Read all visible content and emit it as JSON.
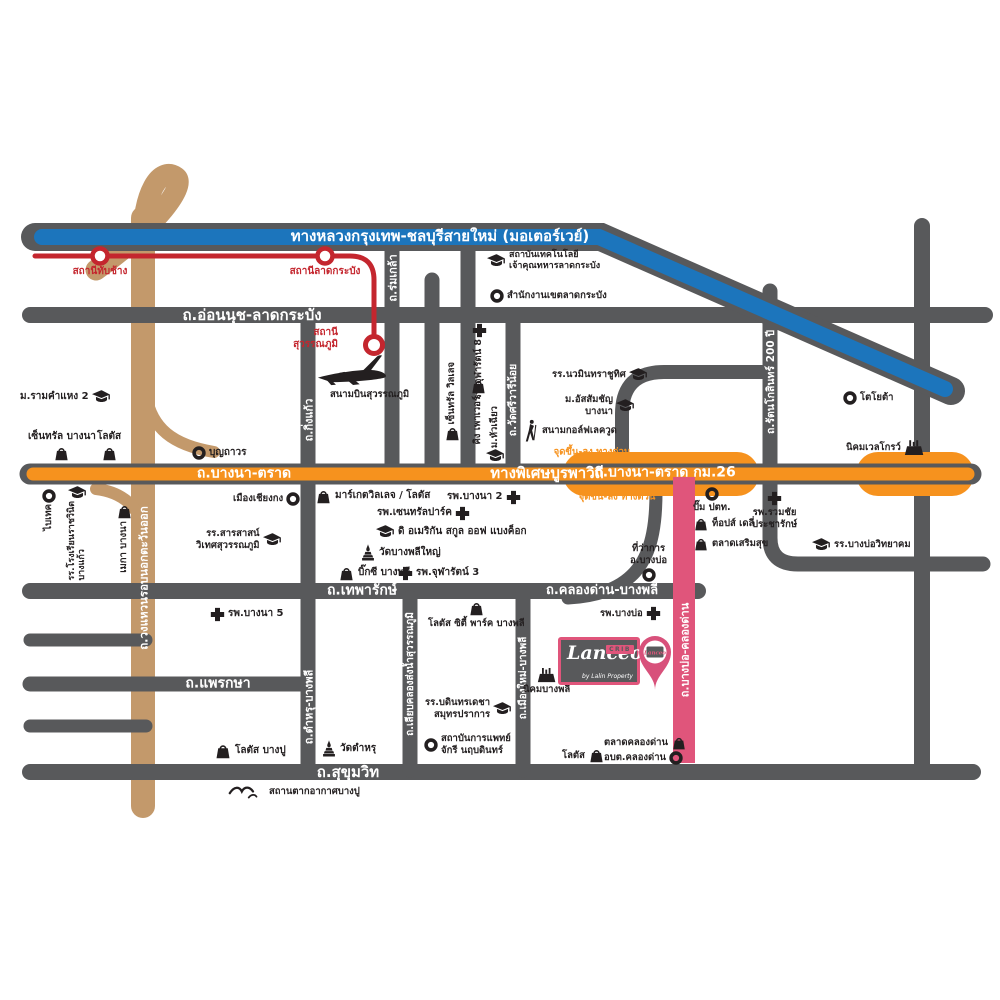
{
  "roads": {
    "motorway": "ทางหลวงกรุงเทพ-ชลบุรีสายใหม่ (มอเตอร์เวย์)",
    "onnut": "ถ.อ่อนนุช-ลาดกระบัง",
    "bangna_trat": "ถ.บางนา-ตราด",
    "burapha": "ทางพิเศษบูรพาวิถี",
    "bangna_trat_km26": "ถ.บางนา-ตราด กม.26",
    "thepharak": "ถ.เทพารักษ์",
    "khlongdan_bangphli": "ถ.คลองด่าน-บางพลี",
    "phraeksa": "ถ.แพรกษา",
    "sukhumvit": "ถ.สุขุมวิท",
    "romklao": "ถ.ร่มเกล้า",
    "kingkaew": "ถ.กิ่งแก้ว",
    "wat_sri_wari_noi": "ถ.วัดศรีวารีน้อย",
    "rattanakosin_200": "ถ.รัตนโกสินทร์ 200 ปี",
    "outer_ring": "ถ.วงแหวนรอบนอกตะวันออก",
    "tamru_bangphli": "ถ.ตำหรุ-บางพลี",
    "liab_khlong": "ถ.เลียบคลองส่งน้ำสุวรรณภูมิ",
    "muangmai_bangphli": "ถ.เมืองใหม่-บางพลี",
    "bangbo_khlongdan": "ถ.บางบ่อ-คลองด่าน"
  },
  "rail": {
    "thap_chang": "สถานีทับช้าง",
    "lat_krabang": "สถานีลาดกระบัง",
    "suvarnabhumi_l1": "สถานี",
    "suvarnabhumi_l2": "สุวรรณภูมิ"
  },
  "notes": {
    "expressway_ramp": "จุดขึ้น-ลง ทางด่วน"
  },
  "airport": {
    "name": "สนามบินสุวรรณภูมิ"
  },
  "pois": {
    "kmitl_l1": "สถาบันเทคโนโลยี",
    "kmitl_l2": "เจ้าคุณทหารลาดกระบัง",
    "district_office": "สำนักงานเขตลาดกระบัง",
    "ram2": "ม.รามคำแหง 2",
    "central_bangna": "เซ็นทรัล บางนา",
    "lotus": "โลตัส",
    "boonthavorn": "บุญถาวร",
    "chularat8": "รพ.จุฬารัตน์ 8",
    "central_village": "เซ็นทรัล วิลเลจ",
    "king_power": "คิง เพาเวอร์",
    "huachiew": "ม.หัวเฉียว",
    "nawamin": "รร.นวมินทราชูทิศ",
    "abac_l1": "ม.อัสสัมชัญ",
    "abac_l2": "บางนา",
    "lakewood": "สนามกอล์ฟเลควูด",
    "toyota": "โตโยต้า",
    "wellgrow": "นิคมเวลโกรว์",
    "bitec": "ไบเทค",
    "ratchawinit_l1": "รร.โรงเรียนราชวินิต",
    "ratchawinit_l2": "บางแก้ว",
    "mega_bangna": "เมกา บางนา",
    "chiangkong": "เมืองเชียงกง",
    "sarasas_l1": "รร.สารสาสน์",
    "sarasas_l2": "วิเทศสุวรรณภูมิ",
    "market_village": "มาร์เกตวิลเลจ / โลตัส",
    "bangna2": "รพ.บางนา 2",
    "central_park": "รพ.เซนทรัลปาร์ค",
    "american_school": "ดิ อเมริกัน สกูล ออฟ แบงค็อก",
    "wat_bangphli_yai": "วัดบางพลีใหญ่",
    "bigc_bangphli": "บิ๊กซี บางพลี",
    "chularat3": "รพ.จุฬารัตน์ 3",
    "ptt": "ปั๊ม ปตท.",
    "tops_daily": "ท็อปส์ เดลี่",
    "talad_soemsuk": "ตลาดเสริมสุข",
    "ruamchai_l1": "รพ.รวมชัย",
    "ruamchai_l2": "ประชารักษ์",
    "bangbo_wit": "รร.บางบ่อวิทยาคม",
    "bangbo_office_l1": "ที่ว่าการ",
    "bangbo_office_l2": "อ.บางบ่อ",
    "bangna5": "รพ.บางนา 5",
    "lotus_bangpu": "โลตัส บางปู",
    "wat_tamru": "วัดตำหรุ",
    "bangpu_resort": "สถานตากอากาศบางปู",
    "lotus_city_park": "โลตัส ซิตี้ พาร์ค บางพลี",
    "bodin_l1": "รร.บดินทรเดชา",
    "bodin_l2": "สมุทรปราการ",
    "chakri_l1": "สถาบันการแพทย์",
    "chakri_l2": "จักรี นฤบดินทร์",
    "bangbo_hosp": "รพ.บางบ่อ",
    "nikhom_bangphli": "นิคมบางพลี",
    "talad_khlongdan": "ตลาดคลองด่าน",
    "lotus_khlongdan": "โลตัส",
    "obt_khlongdan": "อบต.คลองด่าน"
  },
  "logo": {
    "brand": "Lanceo",
    "tag": "CRIB",
    "byline": "by Lalin Property"
  },
  "colors": {
    "road_gray": "#58595b",
    "motorway_blue": "#1c75bc",
    "expressway_orange": "#f6921e",
    "ring_road_brown": "#c3996b",
    "rail_red": "#c4262e",
    "project_pink": "#e0557b"
  }
}
